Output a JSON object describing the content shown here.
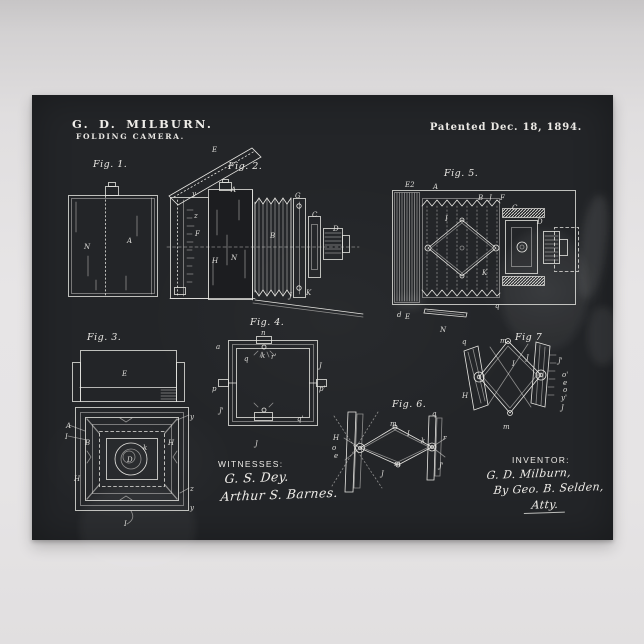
{
  "poster": {
    "colors": {
      "paper": "#232528",
      "ink": "#e7e6e2",
      "wall": "#e4e2e3"
    },
    "header": {
      "title": "G. D. MILBURN.",
      "subtitle": "FOLDING CAMERA.",
      "patent_date": "Patented Dec. 18, 1894."
    },
    "figures": [
      {
        "id": "fig1",
        "caption": "Fig. 1.",
        "parts": [
          {
            "t": "N",
            "x": 22,
            "y": 69
          },
          {
            "t": "A",
            "x": 65,
            "y": 63
          }
        ]
      },
      {
        "id": "fig2",
        "caption": "Fig. 2.",
        "parts": [
          {
            "t": "E",
            "x": 45,
            "y": 12
          },
          {
            "t": "y",
            "x": 25,
            "y": 56
          },
          {
            "t": "A",
            "x": 64,
            "y": 52
          },
          {
            "t": "z",
            "x": 27,
            "y": 78
          },
          {
            "t": "F",
            "x": 28,
            "y": 96
          },
          {
            "t": "H",
            "x": 45,
            "y": 123
          },
          {
            "t": "N",
            "x": 64,
            "y": 120
          },
          {
            "t": "B",
            "x": 103,
            "y": 98
          },
          {
            "t": "G",
            "x": 128,
            "y": 58
          },
          {
            "t": "C",
            "x": 145,
            "y": 77
          },
          {
            "t": "D",
            "x": 166,
            "y": 91
          },
          {
            "t": "J",
            "x": 122,
            "y": 158
          },
          {
            "t": "K",
            "x": 139,
            "y": 155
          }
        ]
      },
      {
        "id": "fig3",
        "caption": "Fig. 3.",
        "parts": [
          {
            "t": "E",
            "x": 57,
            "y": 33
          },
          {
            "t": "y",
            "x": 125,
            "y": 76
          },
          {
            "t": "A",
            "x": 1,
            "y": 85
          },
          {
            "t": "I",
            "x": 0,
            "y": 96
          },
          {
            "t": "B",
            "x": 20,
            "y": 102
          },
          {
            "t": "H",
            "x": 103,
            "y": 102
          },
          {
            "t": "k",
            "x": 78,
            "y": 107
          },
          {
            "t": "H",
            "x": 9,
            "y": 138
          },
          {
            "t": "D",
            "x": 62,
            "y": 119
          },
          {
            "t": "z",
            "x": 125,
            "y": 148
          },
          {
            "t": "y",
            "x": 125,
            "y": 167
          },
          {
            "t": "I",
            "x": 59,
            "y": 183
          }
        ]
      },
      {
        "id": "fig4",
        "caption": "Fig. 4.",
        "parts": [
          {
            "t": "n",
            "x": 49,
            "y": 15
          },
          {
            "t": "a",
            "x": 4,
            "y": 29
          },
          {
            "t": "q",
            "x": 32,
            "y": 41
          },
          {
            "t": "J",
            "x": 107,
            "y": 48
          },
          {
            "t": "p",
            "x": 0,
            "y": 71
          },
          {
            "t": "p'",
            "x": 107,
            "y": 71
          },
          {
            "t": "J'",
            "x": 7,
            "y": 93
          },
          {
            "t": "q'",
            "x": 85,
            "y": 101
          },
          {
            "t": "J",
            "x": 43,
            "y": 126
          },
          {
            "t": "k",
            "x": 49,
            "y": 38
          },
          {
            "t": "r'",
            "x": 59,
            "y": 39
          }
        ]
      },
      {
        "id": "fig5",
        "caption": "Fig. 5.",
        "parts": [
          {
            "t": "E2",
            "x": 23,
            "y": 17
          },
          {
            "t": "A",
            "x": 51,
            "y": 19
          },
          {
            "t": "B",
            "x": 96,
            "y": 30
          },
          {
            "t": "J",
            "x": 107,
            "y": 30
          },
          {
            "t": "F",
            "x": 118,
            "y": 30
          },
          {
            "t": "I",
            "x": 63,
            "y": 51
          },
          {
            "t": "K",
            "x": 100,
            "y": 105
          },
          {
            "t": "C",
            "x": 130,
            "y": 40
          },
          {
            "t": "D",
            "x": 155,
            "y": 54
          },
          {
            "t": "q",
            "x": 113,
            "y": 138
          },
          {
            "t": "d",
            "x": 15,
            "y": 147
          },
          {
            "t": "E",
            "x": 23,
            "y": 149
          },
          {
            "t": "N",
            "x": 58,
            "y": 162
          }
        ]
      },
      {
        "id": "fig6",
        "caption": "Fig. 6.",
        "parts": [
          {
            "t": "H",
            "x": 1,
            "y": 40
          },
          {
            "t": "q",
            "x": 100,
            "y": 16
          },
          {
            "t": "I",
            "x": 75,
            "y": 36
          },
          {
            "t": "m",
            "x": 58,
            "y": 26
          },
          {
            "t": "m",
            "x": 62,
            "y": 66
          },
          {
            "t": "k",
            "x": 89,
            "y": 43
          },
          {
            "t": "r",
            "x": 111,
            "y": 40
          },
          {
            "t": "J'",
            "x": 107,
            "y": 68
          },
          {
            "t": "J",
            "x": 49,
            "y": 76
          },
          {
            "t": "o",
            "x": 0,
            "y": 50
          },
          {
            "t": "e",
            "x": 2,
            "y": 58
          }
        ]
      },
      {
        "id": "fig7",
        "caption": "Fig 7",
        "parts": [
          {
            "t": "q",
            "x": 5,
            "y": 19
          },
          {
            "t": "m",
            "x": 43,
            "y": 18
          },
          {
            "t": "I",
            "x": 55,
            "y": 41
          },
          {
            "t": "J",
            "x": 69,
            "y": 35
          },
          {
            "t": "H",
            "x": 5,
            "y": 73
          },
          {
            "t": "J'",
            "x": 101,
            "y": 38
          },
          {
            "t": "o'",
            "x": 105,
            "y": 52
          },
          {
            "t": "e",
            "x": 106,
            "y": 60
          },
          {
            "t": "o",
            "x": 106,
            "y": 67
          },
          {
            "t": "y'",
            "x": 104,
            "y": 75
          },
          {
            "t": "J",
            "x": 104,
            "y": 85
          },
          {
            "t": "m",
            "x": 46,
            "y": 104
          }
        ]
      }
    ],
    "witnesses": {
      "label": "WITNESSES:",
      "names": [
        "G. S. Dey.",
        "Arthur S. Barnes."
      ]
    },
    "inventor": {
      "label": "INVENTOR:",
      "name": "G. D. Milburn,",
      "by": "By Geo. B. Selden,",
      "atty": "Atty."
    }
  }
}
